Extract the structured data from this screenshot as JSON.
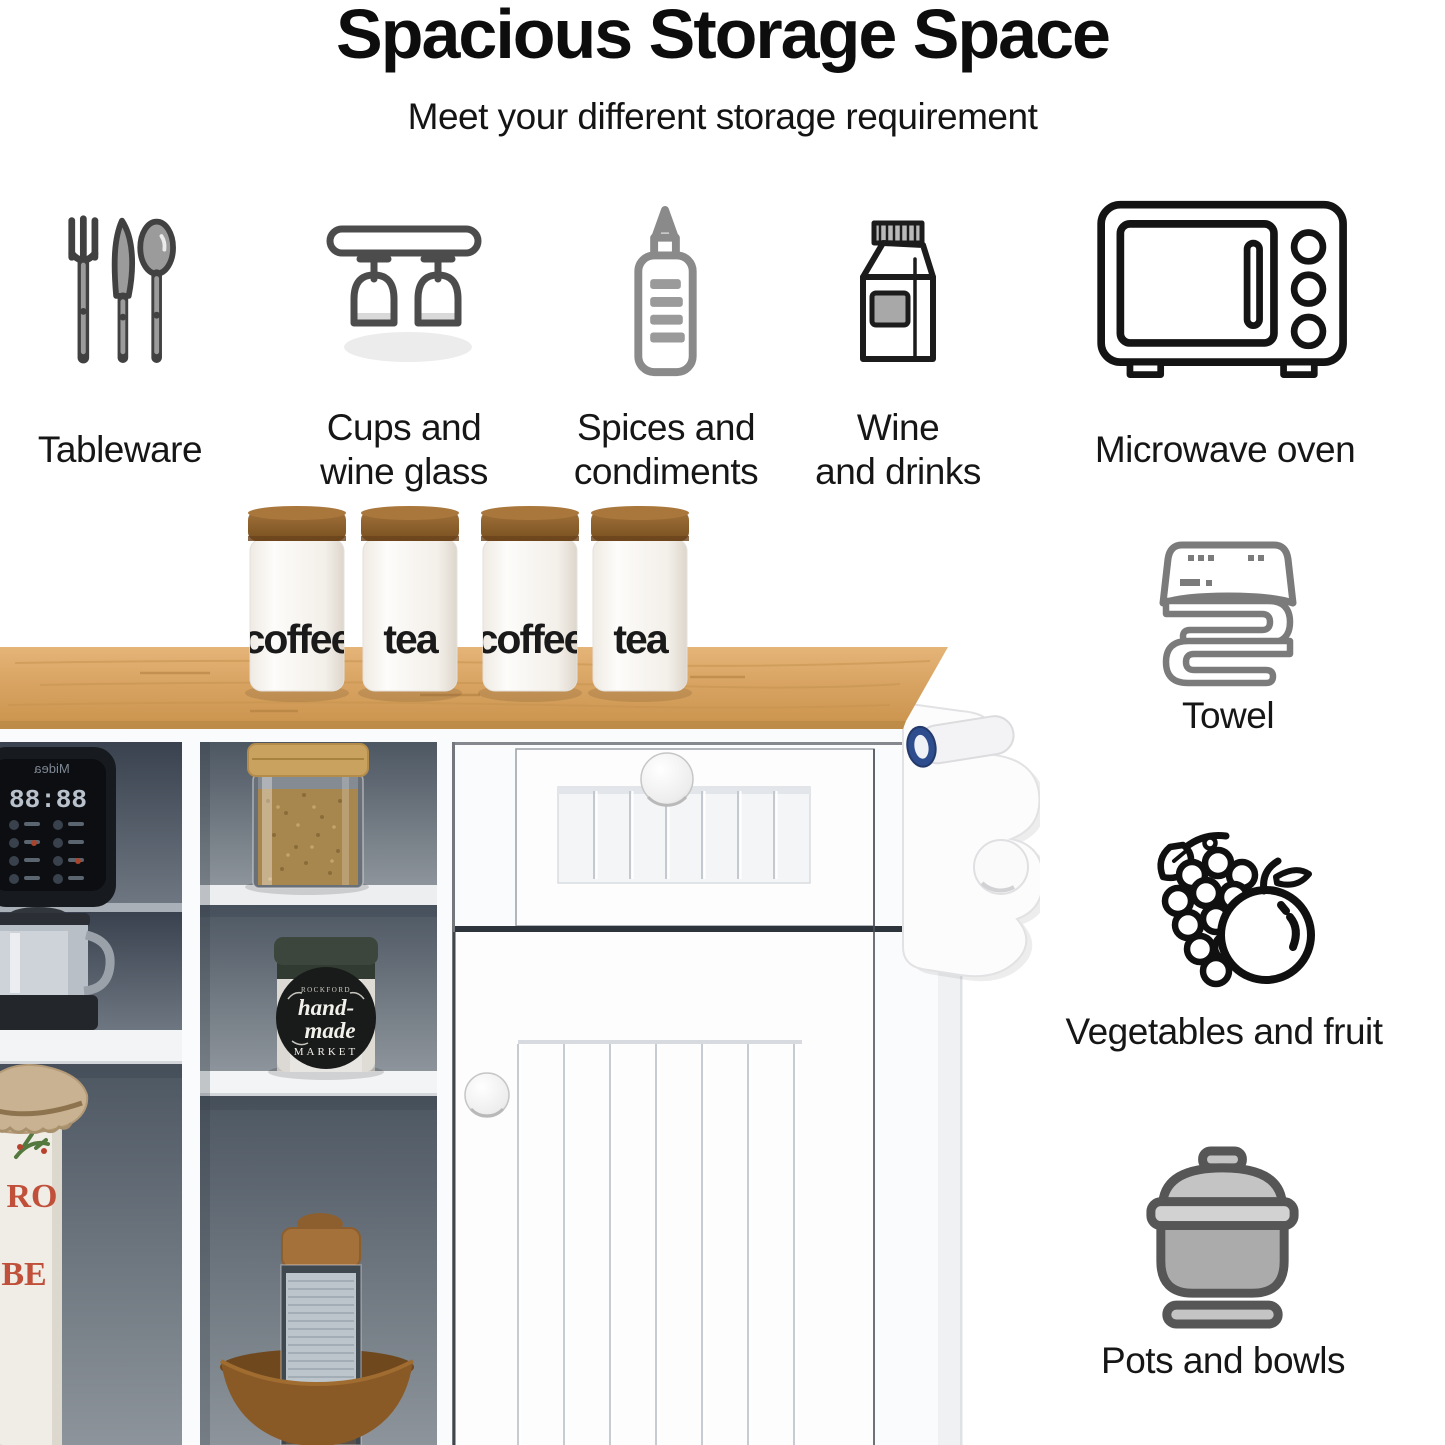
{
  "page": {
    "title": "Spacious Storage Space",
    "subtitle": "Meet your different storage requirement"
  },
  "features_row": [
    {
      "icon": "cutlery-icon",
      "label": "Tableware"
    },
    {
      "icon": "wine-glass-rack-icon",
      "label": "Cups and\nwine glass"
    },
    {
      "icon": "squeeze-bottle-icon",
      "label": "Spices and\ncondiments"
    },
    {
      "icon": "milk-carton-icon",
      "label": "Wine\nand drinks"
    },
    {
      "icon": "microwave-icon",
      "label": "Microwave oven"
    }
  ],
  "features_side": [
    {
      "icon": "towel-icon",
      "label": "Towel"
    },
    {
      "icon": "grapes-orange-icon",
      "label": "Vegetables and fruit"
    },
    {
      "icon": "pot-icon",
      "label": "Pots and bowls"
    }
  ],
  "photo": {
    "canisters": [
      "coffee",
      "tea",
      "coffee",
      "tea"
    ],
    "appliance_display": "88:88",
    "appliance_brand": "Midea",
    "jar_label": {
      "top": "ROCKFORD",
      "line1": "hand-",
      "line2": "made",
      "line3": "MARKET"
    },
    "bottle_text": {
      "line1": "RO",
      "line2": "BE"
    }
  },
  "colors": {
    "icon_gray": "#7b7b7b",
    "icon_dark": "#1a1a1a",
    "wood_top": "#d9a662",
    "cabinet_white": "#fbfbfc",
    "cubby_interior": "#4a545f",
    "towel_bar_cap_blue": "#2e4d8e",
    "jar_lid_green": "#3c463c",
    "bottle_letters_red": "#c0503a",
    "bowl_brown": "#8a5a26"
  }
}
